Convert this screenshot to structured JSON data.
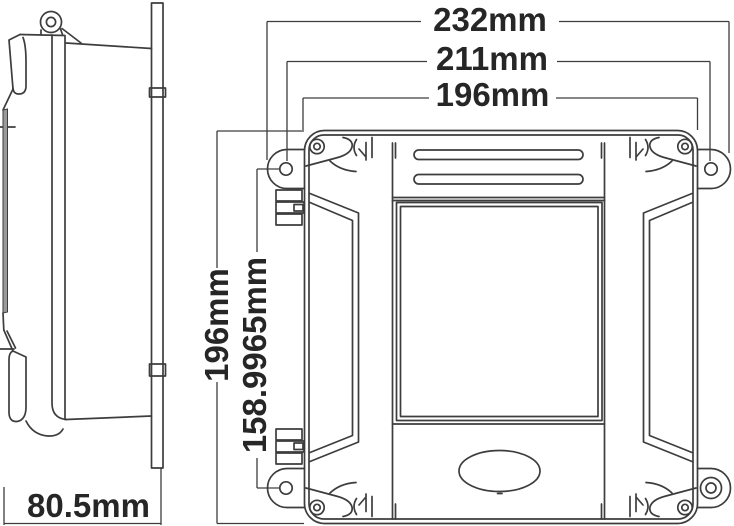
{
  "drawing": {
    "front_view": {
      "overall_width_label": "232mm",
      "mounting_hole_spacing_width_label": "211mm",
      "body_width_label": "196mm",
      "body_height_label": "196mm",
      "mounting_hole_spacing_height_label": "158.9965mm"
    },
    "side_view": {
      "depth_label": "80.5mm"
    },
    "colors": {
      "line": "#3d3d3d",
      "label_text": "#262626",
      "background": "#ffffff",
      "shaded_edge": "#9a9a9a"
    }
  }
}
